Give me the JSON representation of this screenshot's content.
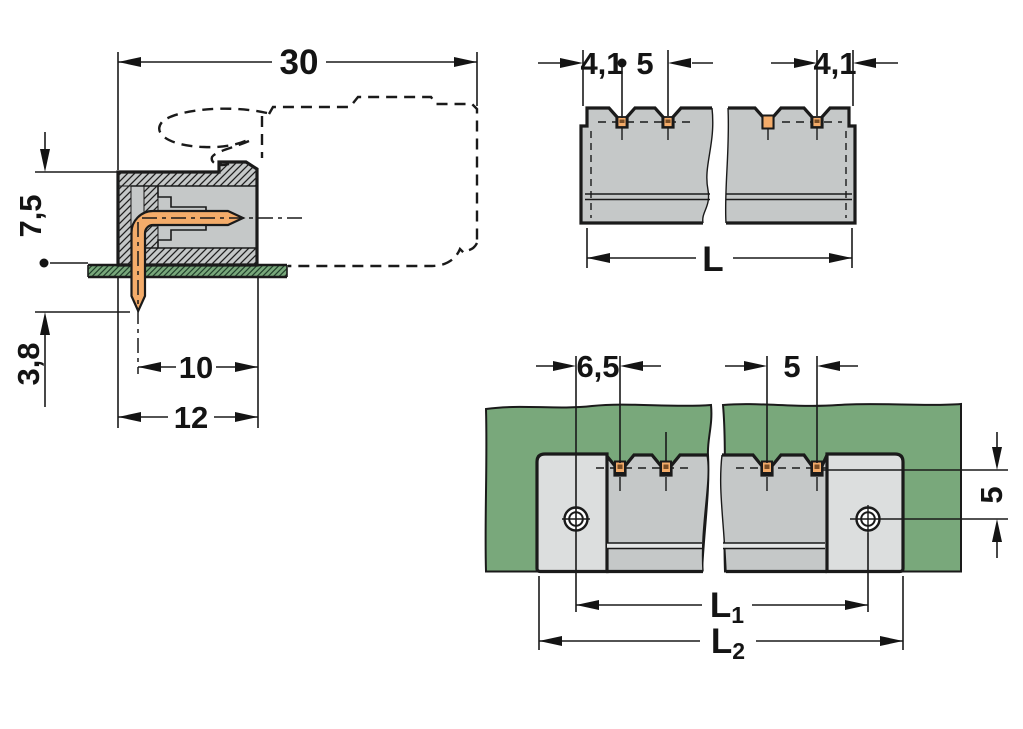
{
  "drawing_title": "Male pin header technical drawing (side section, top view, PCB mounting view)",
  "colors": {
    "outline": "#1a1a1a",
    "body_gray": "#c5c8c8",
    "flange_gray": "#dcdede",
    "pcb_green": "#79a87b",
    "pin_copper": "#f4ac6a",
    "background": "#ffffff"
  },
  "side_view": {
    "dim_total_depth": "30",
    "dim_height_above_pcb": "7,5",
    "dim_pin_length_below_pcb": "3,8",
    "dim_pin_tip_to_face": "10",
    "dim_body_depth": "12"
  },
  "top_view": {
    "dim_end_to_first_pin": "4,1",
    "dim_pin_pitch": "5",
    "dim_last_pin_to_end": "4,1",
    "dim_length_label": "L"
  },
  "bottom_view": {
    "dim_hole_to_first_pin": "6,5",
    "dim_pin_pitch": "5",
    "dim_pin_row_to_hole": "5",
    "dim_hole_spacing_label": "L",
    "dim_hole_spacing_sub": "1",
    "dim_overall_length_label": "L",
    "dim_overall_length_sub": "2"
  }
}
